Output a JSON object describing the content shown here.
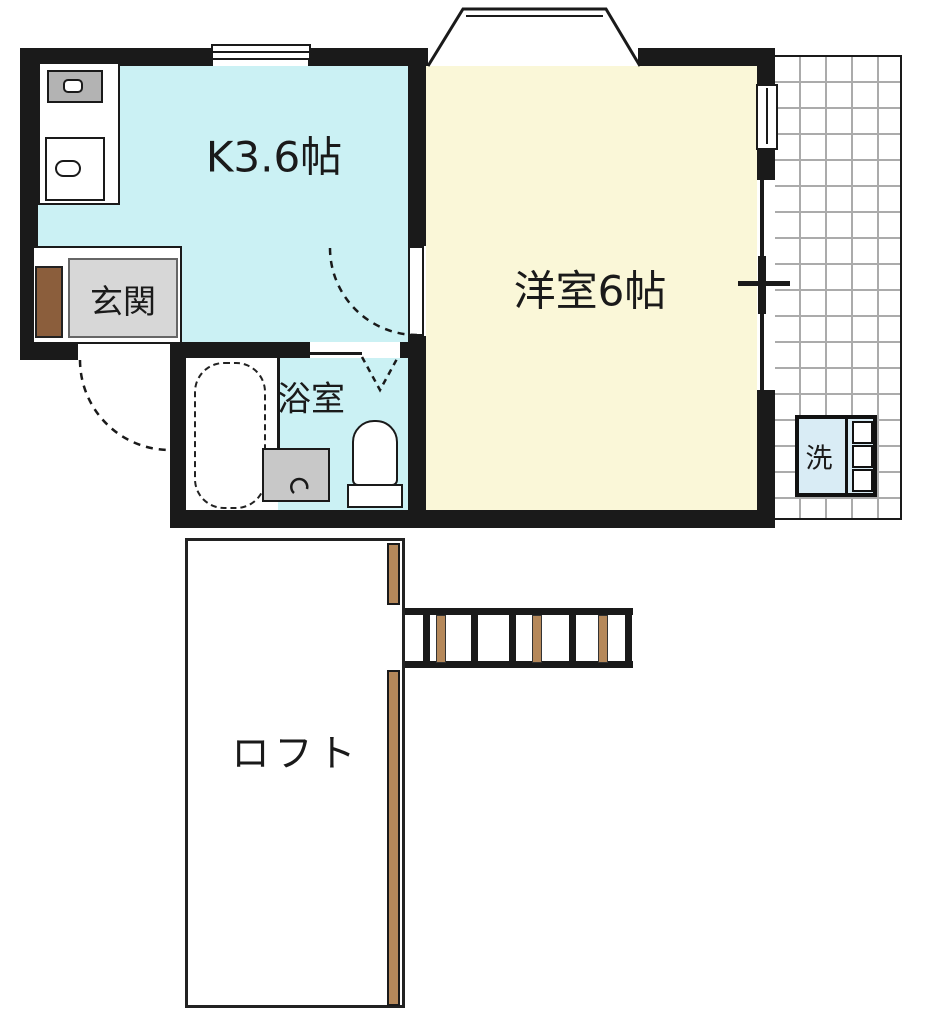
{
  "floorplan": {
    "type": "japanese-apartment-floorplan",
    "rooms": {
      "kitchen": {
        "label": "K3.6帖",
        "fill": "#cbf1f4"
      },
      "western_room": {
        "label": "洋室6帖",
        "fill": "#faf7d8"
      },
      "entrance": {
        "label": "玄関",
        "fill": "#d7d7d7"
      },
      "bathroom": {
        "label": "浴室",
        "fill": "#cbf1f4"
      },
      "loft": {
        "label": "ロフト",
        "fill": "#ffffff"
      },
      "washer": {
        "label": "洗",
        "fill": "#d9ecf5"
      }
    },
    "colors": {
      "wall": "#1a1a1a",
      "wood": "#b5885a",
      "entrance_door_brown": "#8b5e3c",
      "stove_gray": "#b3b3b3",
      "vanity_gray": "#c8c8c8",
      "balcony_grid_line": "#ababab",
      "washer_fill": "#d9ecf5"
    }
  }
}
